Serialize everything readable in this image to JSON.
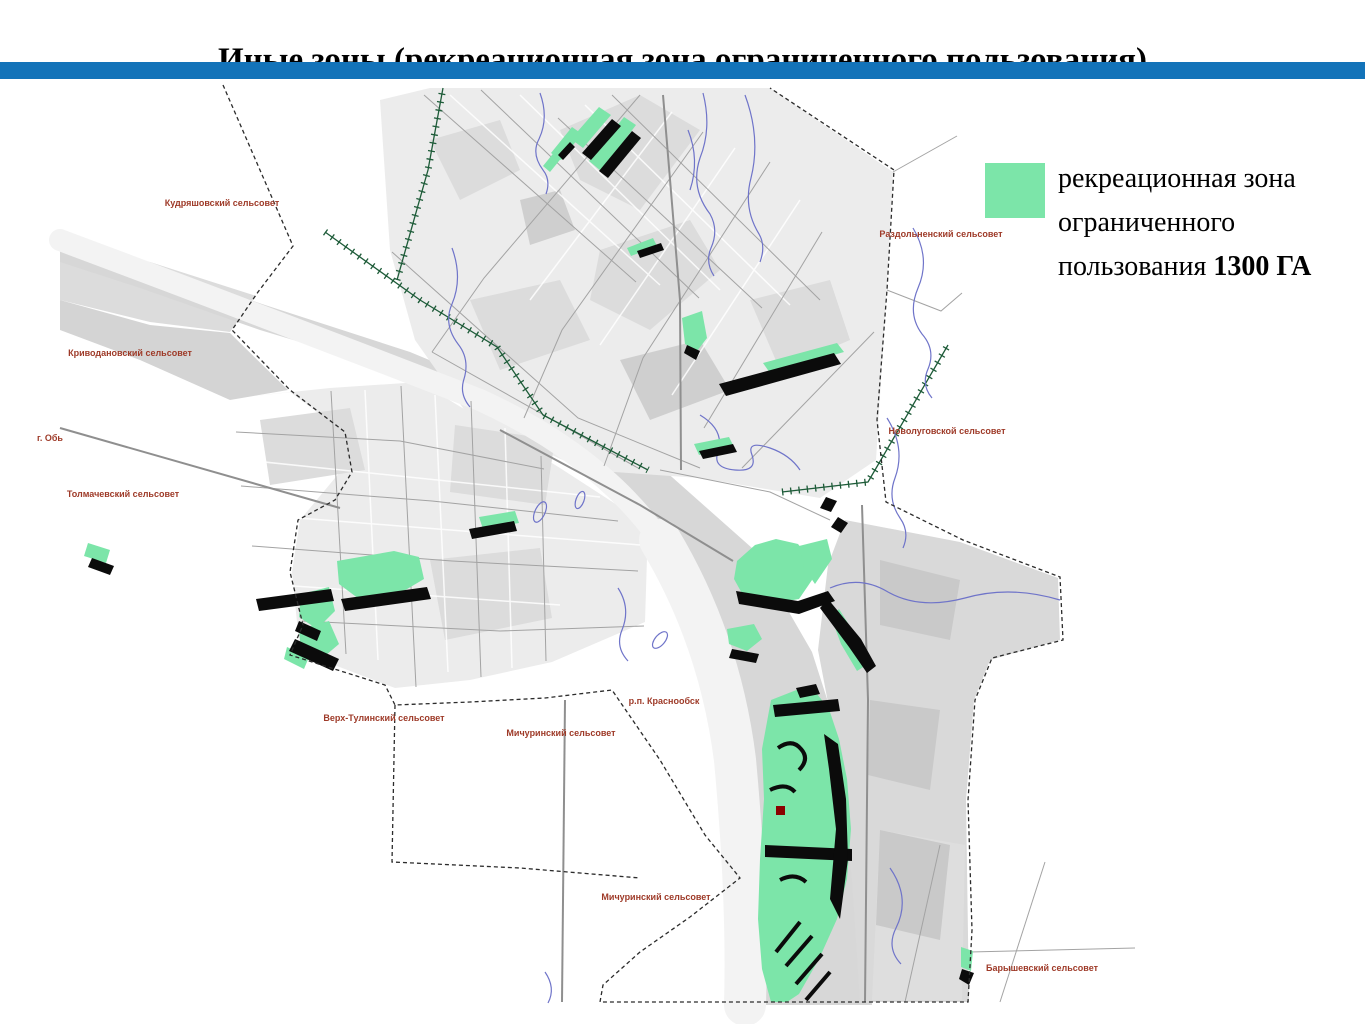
{
  "title": {
    "text": "Иные зоны (рекреационная зона ограниченного пользования)"
  },
  "header": {
    "bar_color": "#1373b9"
  },
  "legend": {
    "swatch_color": "#7ce5a9",
    "line1": "рекреационная зона",
    "line2": "ограниченного",
    "line3_normal": "пользования ",
    "line3_bold": "1300 ГА"
  },
  "map": {
    "colors": {
      "zone_green": "#7ce5a9",
      "zone_black": "#0b0b0b",
      "boundary": "#2b2b2b",
      "road": "#a3a3a3",
      "road_main": "#8f8f8f",
      "water": "#6f74c9",
      "railway": "#1d5b38",
      "urban_light": "#ececec",
      "urban_mid": "#dcdcdc",
      "urban_dark": "#cfcfcf",
      "valley_gray": "#d7d7d7",
      "river_channel": "#f3f3f3",
      "label_red": "#9e3a28",
      "marker_red": "#8b0000"
    },
    "labels": [
      {
        "text": "Кудряшовский сельсовет",
        "x": 222,
        "y": 203
      },
      {
        "text": "Криводановский сельсовет",
        "x": 130,
        "y": 353
      },
      {
        "text": "г. Обь",
        "x": 50,
        "y": 438
      },
      {
        "text": "Толмачевский сельсовет",
        "x": 123,
        "y": 494
      },
      {
        "text": "Раздольненский сельсовет",
        "x": 941,
        "y": 234
      },
      {
        "text": "Новолуговской сельсовет",
        "x": 947,
        "y": 431
      },
      {
        "text": "Верх-Тулинский сельсовет",
        "x": 384,
        "y": 718
      },
      {
        "text": "Мичуринский сельсовет",
        "x": 561,
        "y": 733
      },
      {
        "text": "р.п. Краснообск",
        "x": 664,
        "y": 701
      },
      {
        "text": "Мичуринский сельсовет",
        "x": 656,
        "y": 897
      },
      {
        "text": "Барышевский сельсовет",
        "x": 1042,
        "y": 968
      }
    ]
  }
}
